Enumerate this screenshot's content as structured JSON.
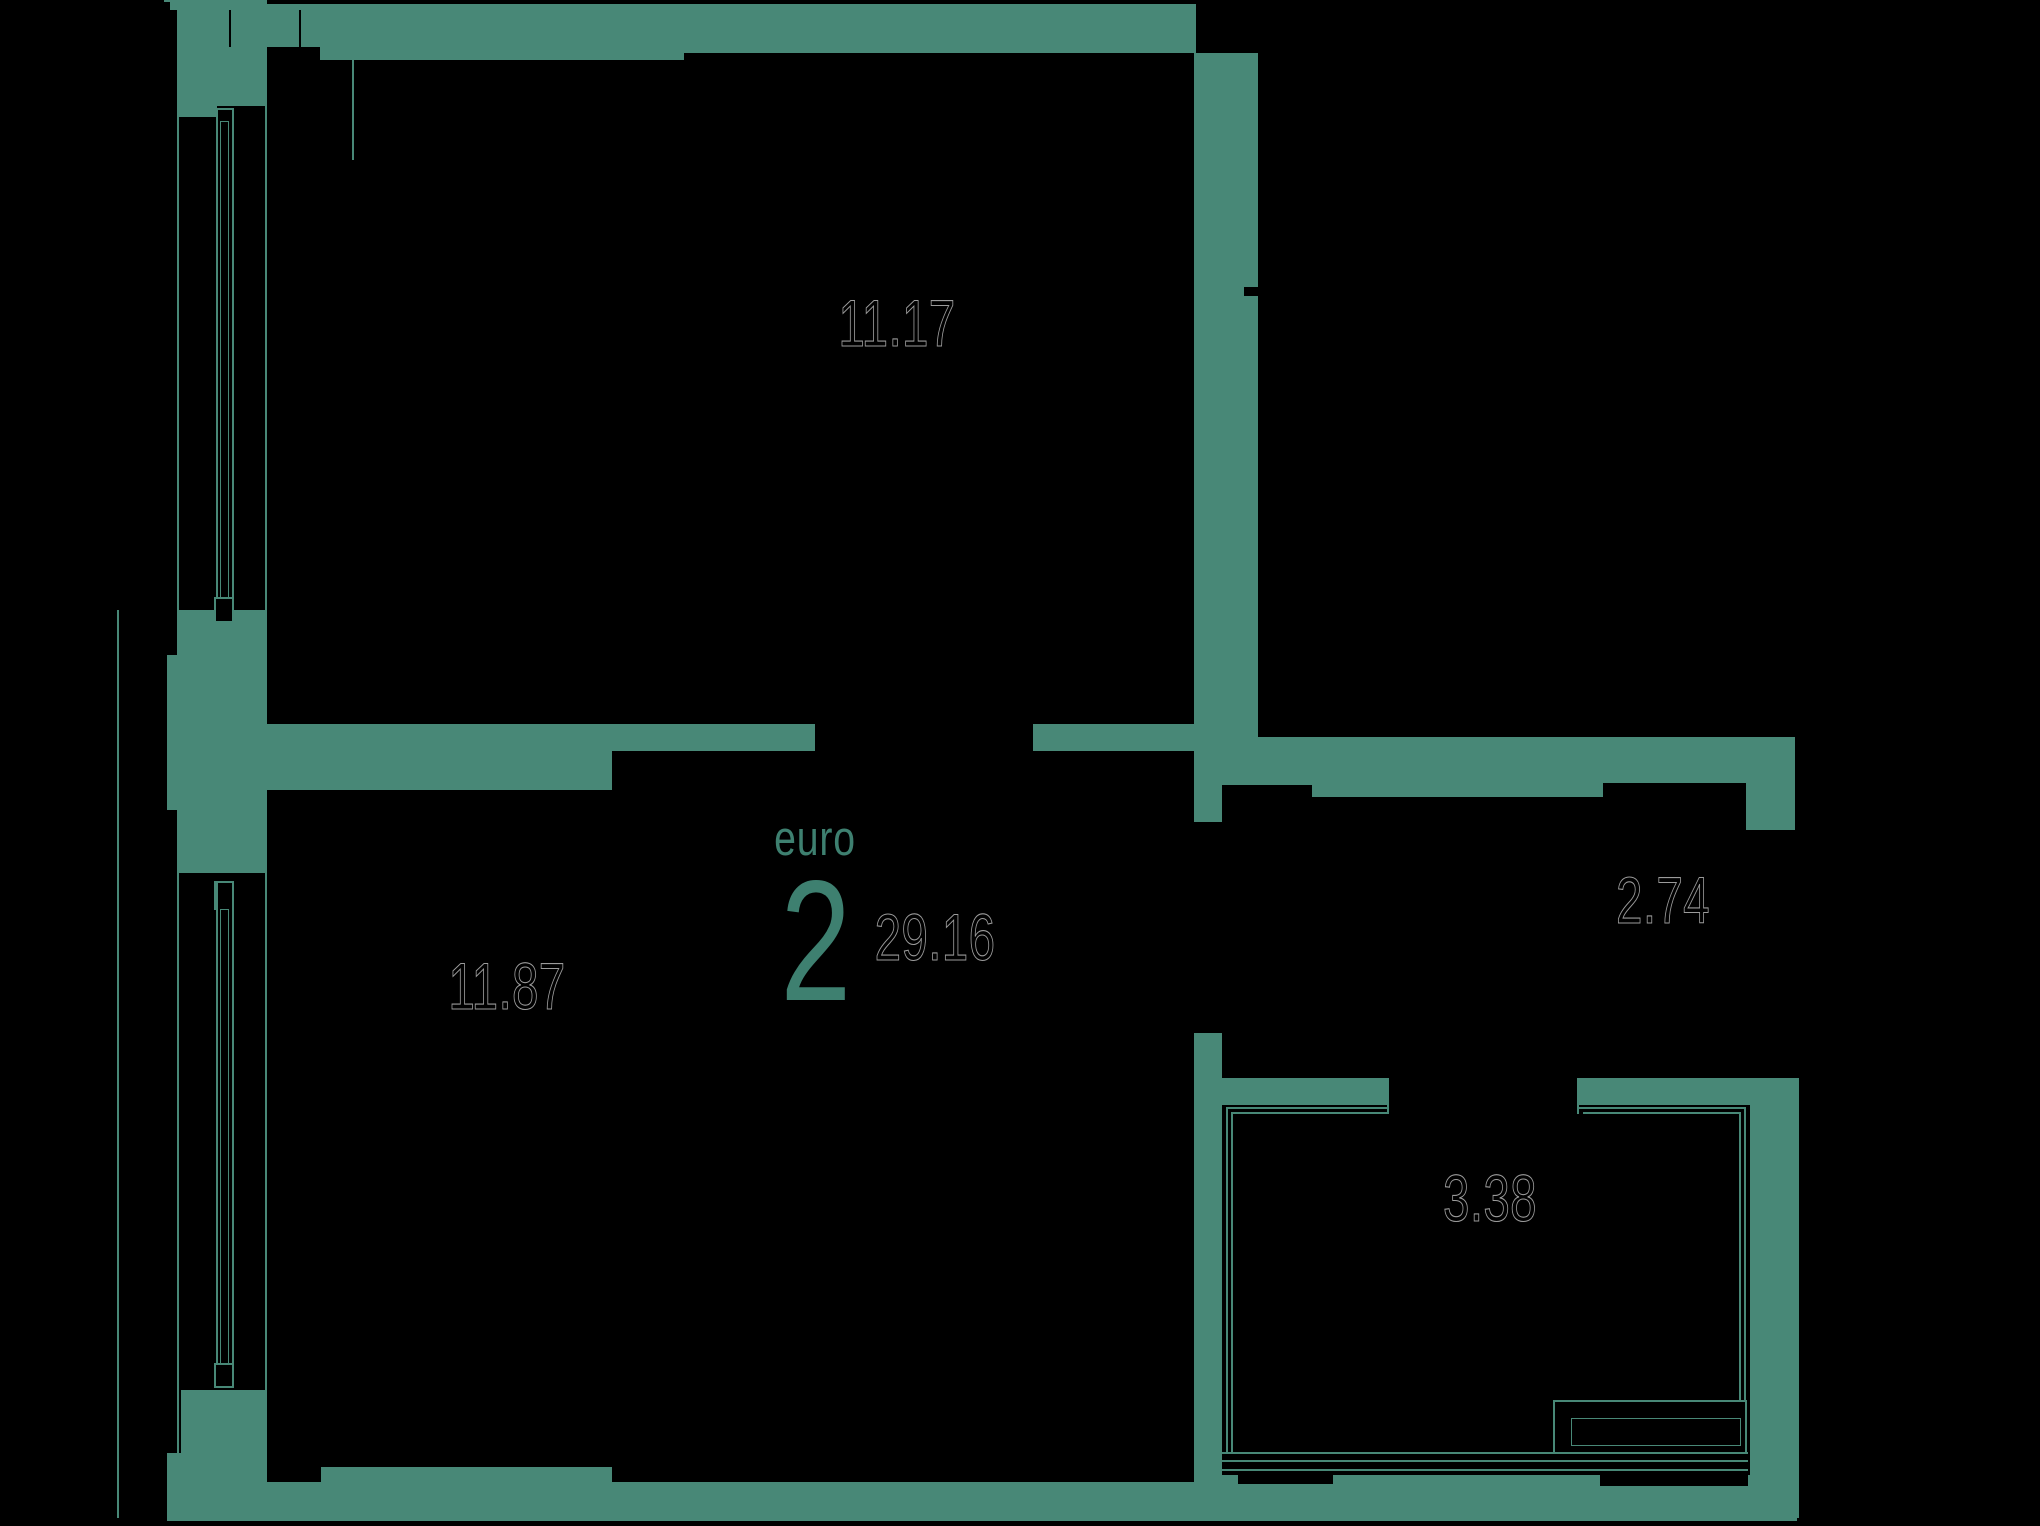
{
  "meta": {
    "width": 2040,
    "height": 1526,
    "background": "#000000"
  },
  "palette": {
    "wall": "#488877",
    "accent": "#3E8070",
    "label_ink": "#000000",
    "label_outline": "#9b9b9b"
  },
  "unit": {
    "type_word": "euro",
    "rooms_number": "2",
    "total_area": "29.16"
  },
  "rooms": [
    {
      "id": "bedroom-top",
      "area": "11.17"
    },
    {
      "id": "bedroom-bottom",
      "area": "11.87"
    },
    {
      "id": "hallway",
      "area": "2.74"
    },
    {
      "id": "bathroom",
      "area": "3.38"
    }
  ],
  "floorplan": {
    "walls": [
      {
        "n": "wall-topleft-sliver",
        "r": [
          164,
          0,
          14,
          10
        ]
      },
      {
        "n": "wall-topleft-corner-block",
        "r": [
          178,
          0,
          89,
          106
        ]
      },
      {
        "n": "wall-topleft-corner-step",
        "r": [
          178,
          106,
          39,
          11
        ]
      },
      {
        "n": "wall-top-segment-1",
        "r": [
          267,
          4,
          53,
          43
        ]
      },
      {
        "n": "wall-top-segment-2",
        "r": [
          320,
          4,
          364,
          56
        ]
      },
      {
        "n": "wall-top-segment-3",
        "r": [
          684,
          4,
          512,
          49
        ]
      },
      {
        "n": "wall-east-column",
        "r": [
          1194,
          53,
          64,
          732
        ]
      },
      {
        "n": "wall-east-column-foot",
        "r": [
          1194,
          785,
          28,
          37
        ]
      },
      {
        "n": "wall-middle-thick",
        "r": [
          267,
          724,
          345,
          66
        ]
      },
      {
        "n": "wall-middle-thin-west",
        "r": [
          612,
          724,
          203,
          27
        ]
      },
      {
        "n": "wall-middle-thin-east",
        "r": [
          1033,
          724,
          161,
          27
        ]
      },
      {
        "n": "wall-left-mid-block",
        "r": [
          179,
          610,
          88,
          263
        ]
      },
      {
        "n": "wall-left-mid-pilaster",
        "r": [
          167,
          655,
          12,
          155
        ]
      },
      {
        "n": "wall-left-bottom-block",
        "r": [
          181,
          1390,
          85,
          131
        ]
      },
      {
        "n": "wall-left-bottom-pilaster",
        "r": [
          167,
          1453,
          14,
          68
        ]
      },
      {
        "n": "wall-bottom-main",
        "r": [
          266,
          1482,
          956,
          39
        ]
      },
      {
        "n": "wall-bottom-lip",
        "r": [
          321,
          1467,
          291,
          15
        ]
      },
      {
        "n": "wall-hall-top-band",
        "r": [
          1258,
          737,
          537,
          60
        ]
      },
      {
        "n": "wall-right-upper",
        "r": [
          1746,
          738,
          49,
          92
        ]
      },
      {
        "n": "wall-right-lower",
        "r": [
          1750,
          1078,
          47,
          439
        ]
      },
      {
        "n": "wall-bath-top-west",
        "r": [
          1222,
          1078,
          167,
          27
        ]
      },
      {
        "n": "wall-bath-top-east",
        "r": [
          1578,
          1078,
          172,
          27
        ]
      },
      {
        "n": "wall-bath-left-column",
        "r": [
          1194,
          1033,
          28,
          449
        ]
      },
      {
        "n": "wall-bath-bottom-band",
        "r": [
          1222,
          1475,
          575,
          46
        ]
      }
    ],
    "black": [
      {
        "n": "notch-topleft-square",
        "r": [
          158,
          2,
          12,
          8
        ]
      },
      {
        "n": "notch-band-west",
        "r": [
          1258,
          785,
          54,
          12
        ]
      },
      {
        "n": "notch-band-east",
        "r": [
          1603,
          783,
          143,
          14
        ]
      },
      {
        "n": "notch-column-tick",
        "r": [
          1244,
          287,
          14,
          9
        ]
      },
      {
        "n": "hairline-top-wall-1",
        "r": [
          229,
          10,
          2,
          37
        ]
      },
      {
        "n": "hairline-top-wall-2",
        "r": [
          299,
          10,
          2,
          37
        ]
      },
      {
        "n": "inset-bottom-west",
        "r": [
          1238,
          1473,
          95,
          11
        ]
      },
      {
        "n": "inset-bottom-east",
        "r": [
          1600,
          1473,
          148,
          13
        ]
      }
    ],
    "lines": [
      {
        "n": "facade-line-outer",
        "r": [
          117,
          610,
          2,
          908
        ]
      },
      {
        "n": "facade-line-wall-face",
        "r": [
          177,
          0,
          2,
          1518
        ]
      },
      {
        "n": "interior-face-line",
        "r": [
          265,
          47,
          2,
          1435
        ]
      },
      {
        "n": "facade-line-short",
        "r": [
          352,
          57,
          2,
          103
        ]
      },
      {
        "n": "right-wall-outer-line",
        "r": [
          1797,
          1078,
          2,
          440
        ]
      },
      {
        "n": "bath-door-jamb-west",
        "r": [
          1387,
          1078,
          2,
          36
        ]
      },
      {
        "n": "bath-door-jamb-east",
        "r": [
          1577,
          1078,
          2,
          36
        ]
      },
      {
        "n": "bath-threshold-line-1",
        "r": [
          1222,
          1452,
          526,
          2
        ]
      },
      {
        "n": "bath-threshold-line-2",
        "r": [
          1222,
          1460,
          526,
          2
        ]
      },
      {
        "n": "bath-threshold-line-3",
        "r": [
          1222,
          1469,
          526,
          2
        ]
      },
      {
        "n": "bath-outline-top-west",
        "r": [
          1226,
          1107,
          163,
          2
        ]
      },
      {
        "n": "bath-outline-top-west-inner",
        "r": [
          1231,
          1112,
          158,
          2
        ]
      },
      {
        "n": "bath-outline-top-east",
        "r": [
          1578,
          1107,
          168,
          2
        ]
      },
      {
        "n": "bath-outline-top-east-inner",
        "r": [
          1583,
          1112,
          158,
          2
        ]
      },
      {
        "n": "bath-outline-left",
        "r": [
          1226,
          1107,
          2,
          345
        ]
      },
      {
        "n": "bath-outline-left-inner",
        "r": [
          1231,
          1112,
          2,
          340
        ]
      },
      {
        "n": "bath-outline-right",
        "r": [
          1744,
          1107,
          2,
          345
        ]
      },
      {
        "n": "bath-outline-right-inner",
        "r": [
          1739,
          1112,
          2,
          340
        ]
      }
    ],
    "boxes": [
      {
        "n": "window-top-frame",
        "r": [
          216,
          108,
          18,
          503
        ],
        "thin": false
      },
      {
        "n": "window-top-glazing",
        "r": [
          220,
          121,
          9,
          477
        ],
        "thin": true
      },
      {
        "n": "window-top-sill-cap",
        "r": [
          214,
          597,
          20,
          26
        ],
        "thin": false
      },
      {
        "n": "window-bottom-head-cap",
        "r": [
          214,
          881,
          20,
          29
        ],
        "thin": false
      },
      {
        "n": "window-bottom-frame",
        "r": [
          216,
          881,
          18,
          507
        ],
        "thin": false
      },
      {
        "n": "window-bottom-glazing",
        "r": [
          220,
          909,
          9,
          455
        ],
        "thin": true
      },
      {
        "n": "window-bottom-sill-cap",
        "r": [
          214,
          1363,
          20,
          25
        ],
        "thin": false
      },
      {
        "n": "bathtub-outer",
        "r": [
          1553,
          1400,
          194,
          54
        ],
        "thin": false
      },
      {
        "n": "bathtub-inner",
        "r": [
          1571,
          1418,
          170,
          28
        ],
        "thin": true
      }
    ],
    "labels": [
      {
        "n": "label-area-room-11-17",
        "text": "11.17",
        "x": 897,
        "y": 323,
        "cls": ""
      },
      {
        "n": "label-area-room-11-87",
        "text": "11.87",
        "x": 507,
        "y": 986,
        "cls": ""
      },
      {
        "n": "label-area-hall-2-74",
        "text": "2.74",
        "x": 1663,
        "y": 900,
        "cls": ""
      },
      {
        "n": "label-area-bath-3-38",
        "text": "3.38",
        "x": 1490,
        "y": 1198,
        "cls": ""
      },
      {
        "n": "label-total-area",
        "text": "29.16",
        "x": 935,
        "y": 937,
        "cls": ""
      },
      {
        "n": "label-euro-word",
        "text": "euro",
        "x": 815,
        "y": 839,
        "cls": "accent word"
      },
      {
        "n": "label-euro-number",
        "text": "2",
        "x": 816,
        "y": 945,
        "cls": "accent big"
      }
    ]
  }
}
